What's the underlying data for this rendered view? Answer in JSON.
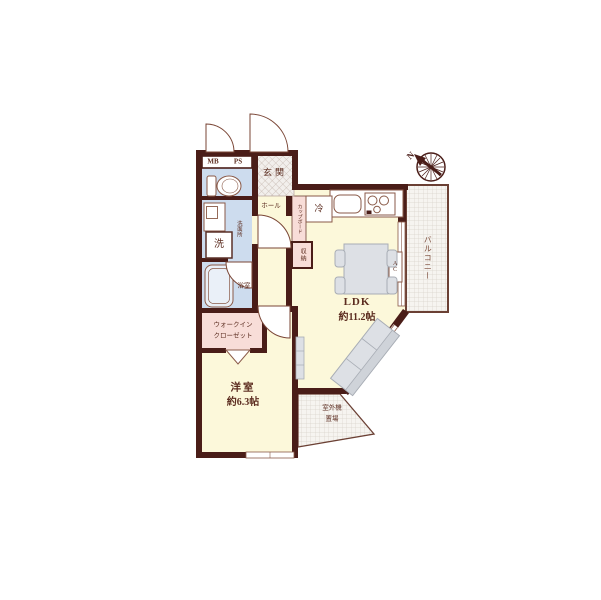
{
  "colors": {
    "wall": "#4a1d18",
    "floor": "#fcf8da",
    "wet_area": "#cddcee",
    "closet": "#f8ddd8",
    "fixture_outline": "#8a5a48",
    "balcony_outline": "#6b4034",
    "furniture": "#dde0e5",
    "text": "#5c2d20"
  },
  "rooms": {
    "entrance": {
      "label": "玄関"
    },
    "hall": {
      "label": "ホール"
    },
    "ldk": {
      "label": "LDK",
      "area": "約11.2帖"
    },
    "western_room": {
      "label": "洋室",
      "area": "約6.3帖"
    },
    "walk_in_closet": {
      "label_line1": "ウォークイン",
      "label_line2": "クローゼット"
    },
    "washroom": {
      "label": "洗面所"
    },
    "bathroom": {
      "label": "浴室"
    },
    "balcony": {
      "label": "バルコニー"
    },
    "outdoor_unit_space": {
      "label_line1": "室外機",
      "label_line2": "置場"
    },
    "storage": {
      "label": "収納"
    },
    "cupboard": {
      "label": "カップボード"
    }
  },
  "fixtures": {
    "meter_box": "MB",
    "pipe_space": "PS",
    "refrigerator": "冷",
    "washing_machine": "洗",
    "air_conditioner": "AC"
  },
  "compass": {
    "north_label": "N"
  }
}
